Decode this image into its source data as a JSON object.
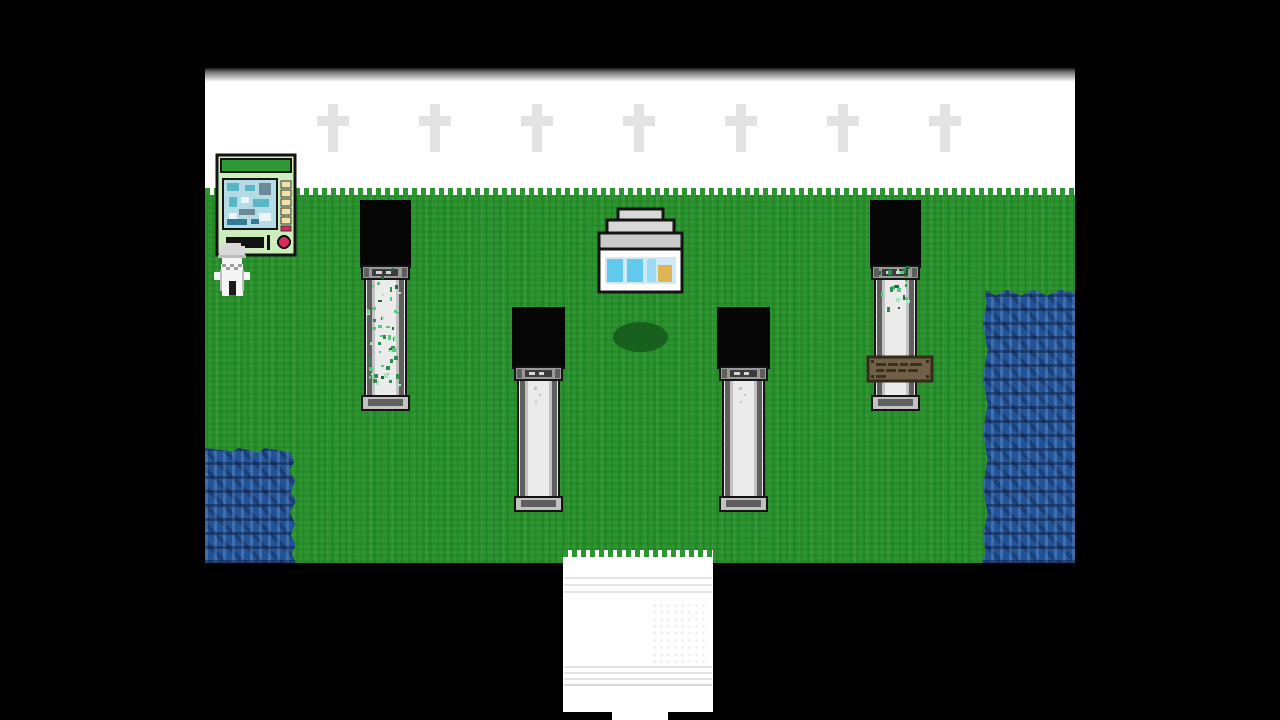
{
  "scene_label": "pixel RPG garden scene with pillars, shrine, vending machine, water and stair exit",
  "colors": {
    "letterbox": "#000000",
    "sky": "#ffffff",
    "cross": "#e3e3e3",
    "grass-base": "#2c9630",
    "water-base": "#235397",
    "outline": "#141414",
    "pillar-top-black": "#060606",
    "pillar-light": "#ebebeb",
    "pillar-midlight": "#c2c2c2",
    "pillar-mid": "#9a9a9a",
    "pillar-dark": "#5f5f5f",
    "vine-green": "#57c87c",
    "machine-body": "#cdeebc",
    "machine-top": "#2f9a35",
    "machine-screen": "#b5dce6",
    "machine-button": "#efe3a8",
    "machine-red": "#dd2a5e",
    "shrine-roof": "#d8d8d8",
    "shrine-band": "#cfe9f5",
    "shrine-item-cyan": "#62c9ef",
    "shrine-item-tan": "#dfb457",
    "sign-brown": "#6f6047",
    "sign-dark": "#352b1b",
    "shadow-oval": "#17601e",
    "path-white": "#ffffff",
    "path-line": "#e4e4e4",
    "char-white": "#f5f5f5",
    "char-gray": "#d8d8d8",
    "char-dark": "#1c1c1c"
  },
  "scene": {
    "cross_pattern": {
      "count": 7,
      "centers_x": [
        128,
        230,
        332,
        434,
        536,
        638,
        740
      ],
      "top": 44
    },
    "vines": {
      "left_count": 52,
      "right_count": 22
    },
    "objects": [
      "vending-machine",
      "player-character",
      "pillar-vined-left",
      "pillar-inner-left",
      "pillar-inner-right",
      "pillar-vined-right",
      "shrine-kiosk",
      "bush-shadow",
      "wooden-sign",
      "pond-left",
      "river-right",
      "white-stairs-path",
      "cross-pattern"
    ]
  }
}
